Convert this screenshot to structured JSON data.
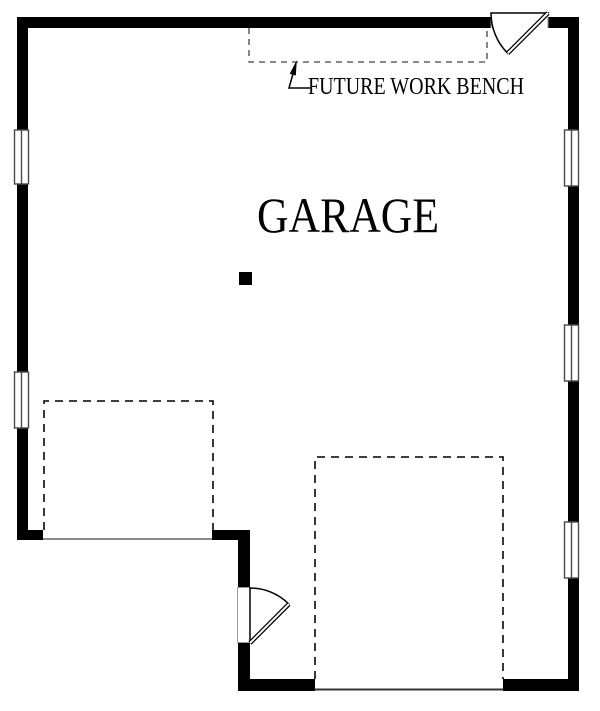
{
  "plan": {
    "room_label": "GARAGE",
    "annotation_label": "FUTURE WORK BENCH"
  },
  "colors": {
    "wall": "#000000",
    "bay_outline": "#222222",
    "bench_outline": "#444444",
    "west_opening_line": "#8a8a8a",
    "south_opening_line": "#333333",
    "window_frame": "#4a4a4a",
    "door_outline": "#000000",
    "door_jamb": "#999999",
    "text": "#000000"
  }
}
